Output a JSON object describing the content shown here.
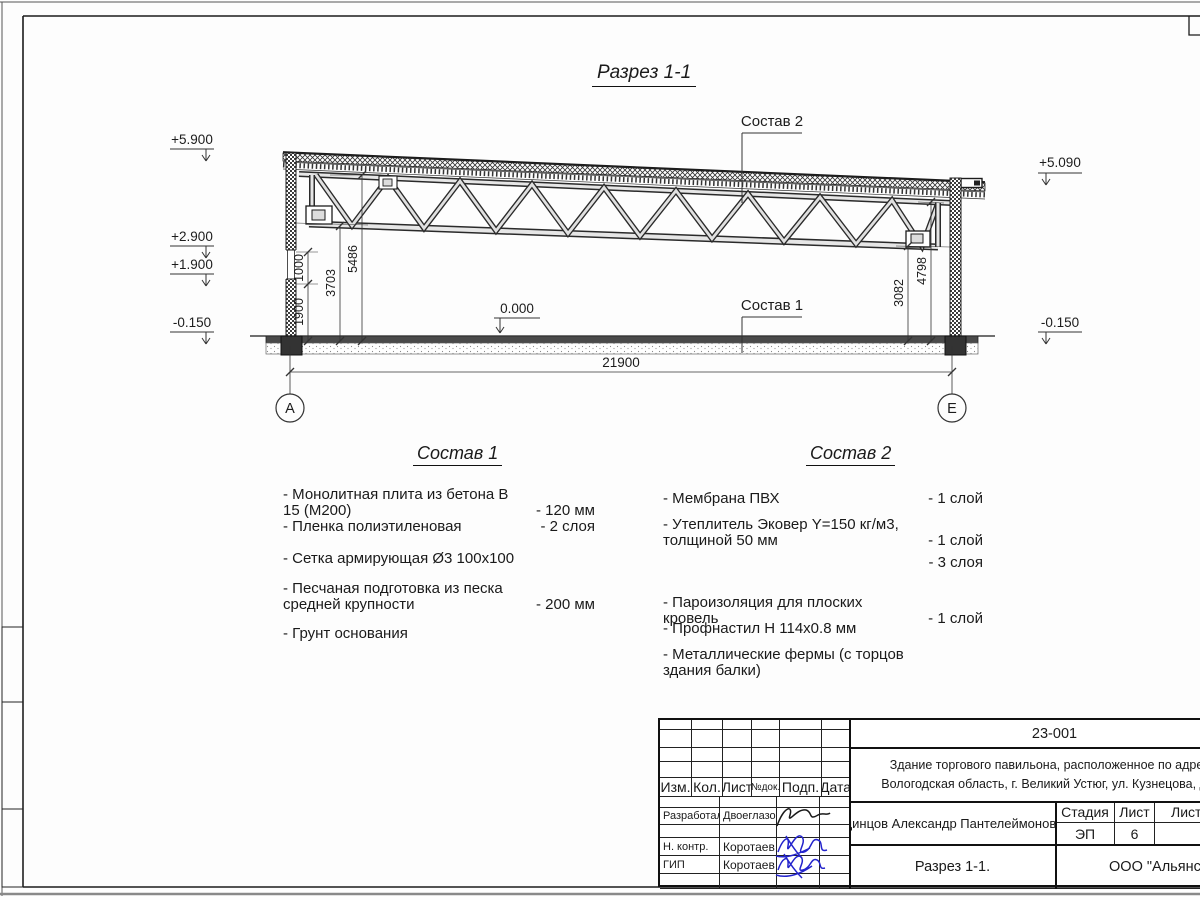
{
  "page": {
    "drawing_title": "Разрез 1-1"
  },
  "section": {
    "elevations_left": [
      "+5.900",
      "+2.900",
      "+1.900",
      "-0.150"
    ],
    "elevation_right_top": "+5.090",
    "elevation_right_bottom": "-0.150",
    "floor_level": "0.000",
    "dims": {
      "d1900": "1900",
      "d1000": "1000",
      "d3703": "3703",
      "d5486": "5486",
      "d3082": "3082",
      "d4798": "4798",
      "span": "21900"
    },
    "axis_left": "А",
    "axis_right": "Е",
    "label_comp1": "Состав 1",
    "label_comp2": "Состав 2"
  },
  "comp1": {
    "heading": "Состав 1",
    "items": [
      {
        "name": "- Монолитная плита из бетона В 15 (М200)",
        "value": "- 120 мм"
      },
      {
        "name": "- Пленка полиэтиленовая",
        "value": "-  2 слоя"
      },
      {
        "name": "- Сетка армирующая Ø3 100х100",
        "value": ""
      },
      {
        "name": "- Песчаная подготовка из песка\n  средней крупности",
        "value": "- 200 мм"
      },
      {
        "name": "- Грунт основания",
        "value": ""
      }
    ]
  },
  "comp2": {
    "heading": "Состав 2",
    "items": [
      {
        "name": "- Мембрана ПВХ",
        "value": "- 1 слой"
      },
      {
        "name": "- Утеплитель Эковер Y=150 кг/м3,\n  толщиной 50 мм",
        "value": "- 1 слой"
      },
      {
        "name": "- Утеплитель Эковер Y=100 кг/м3,\n  толщиной 50 мм",
        "value": "- 3 слоя"
      },
      {
        "name": "- Пароизоляция для плоских кровель",
        "value": "- 1 слой"
      },
      {
        "name": "- Профнастил Н 114х0.8 мм",
        "value": ""
      },
      {
        "name": "- Металлические фермы (с торцов здания балки)",
        "value": ""
      }
    ]
  },
  "title_block": {
    "doc_number": "23-001",
    "project_description": "Здание торгового павильона, расположенное по адресу:\nВологодская область, г. Великий Устюг, ул. Кузнецова, д. 60",
    "col_izm": "Изм.",
    "col_kol": "Кол.",
    "col_list": "Лист",
    "col_doc": "№док.",
    "col_podp": "Подп.",
    "col_data": "Дата",
    "row_developed_label": "Разработал",
    "row_developed_name": "Двоеглазов",
    "row_ncontrol_label": "Н. контр.",
    "row_ncontrol_name": "Коротаев",
    "row_gip_label": "ГИП",
    "row_gip_name": "Коротаев",
    "author": "Одинцов Александр Пантелеймонович",
    "stage_label": "Стадия",
    "sheet_label": "Лист",
    "sheets_label": "Листов",
    "stage": "ЭП",
    "sheet": "6",
    "sheets": "",
    "sheet_title": "Разрез 1-1.",
    "company": "ООО \"Альянс\""
  },
  "colors": {
    "line": "#1c1c1c",
    "signature_blue": "#2323cc"
  }
}
